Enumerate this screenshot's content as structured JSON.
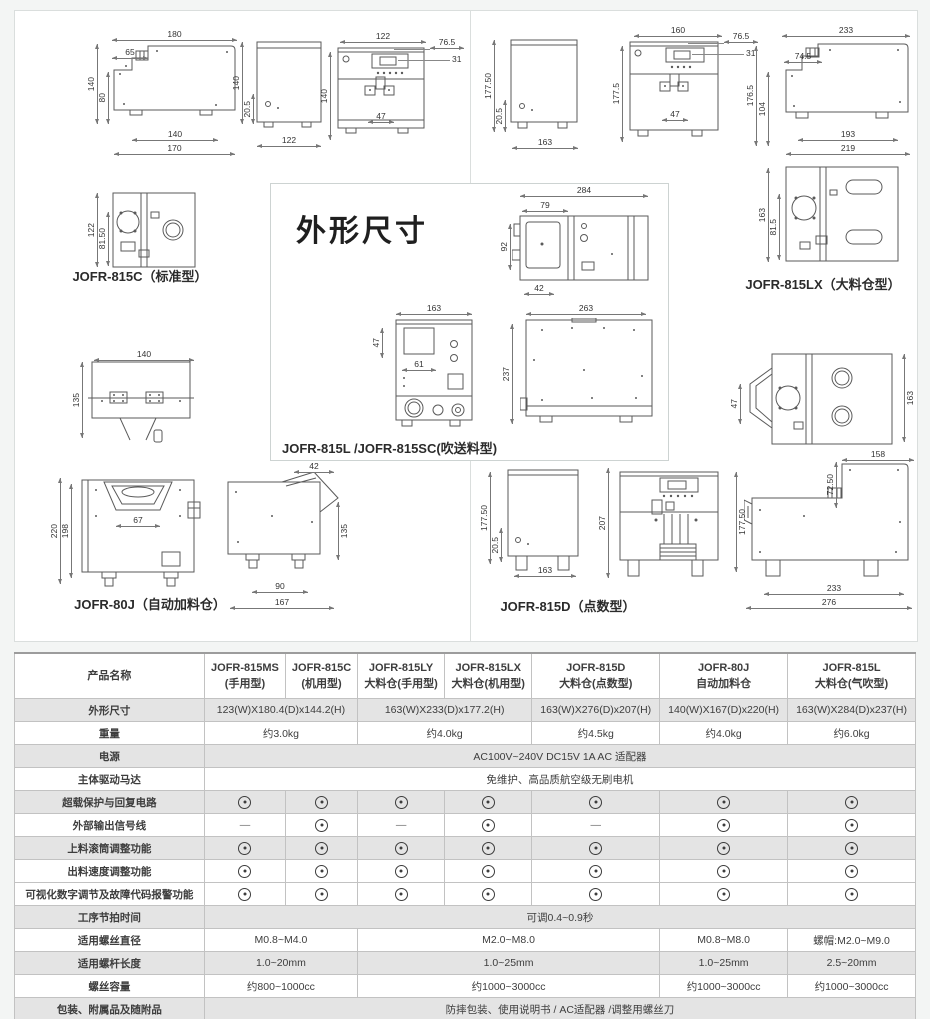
{
  "drawings": {
    "title": "外形尺寸",
    "c": {
      "label": "JOFR-815C（标准型）",
      "side": {
        "top": "180",
        "step": "65",
        "h": "140",
        "h2": "80",
        "bot_in": "140",
        "bot": "170"
      },
      "back": {
        "h": "140",
        "h2": "20.5",
        "w": "122"
      },
      "front": {
        "w": "122",
        "r1": "76.5",
        "r2": "31",
        "h": "140",
        "inner": "47"
      },
      "top": {
        "h": "122",
        "h2": "81.50"
      }
    },
    "hinge": {
      "w": "140",
      "h": "135"
    },
    "j80": {
      "label": "JOFR-80J（自动加料仓）",
      "front": {
        "h": "220",
        "h2": "198",
        "inner": "67"
      },
      "side": {
        "top": "42",
        "r": "135",
        "bot_in": "90",
        "bot": "167"
      }
    },
    "lx": {
      "label": "JOFR-815LX（大料仓型）",
      "back": {
        "h": "177.50",
        "h2": "20.5",
        "w": "163"
      },
      "front": {
        "w": "160",
        "r1": "76.5",
        "r2": "31",
        "h": "177.5",
        "inner": "47"
      },
      "side": {
        "top": "233",
        "step": "74.5",
        "h": "176.5",
        "h2": "104",
        "bot_in": "193",
        "bot": "219"
      },
      "top": {
        "h": "163",
        "h2": "81.5"
      }
    },
    "ltop": {
      "l": "47",
      "r": "163"
    },
    "d": {
      "label": "JOFR-815D（点数型）",
      "back": {
        "h": "177.50",
        "h2": "20.5",
        "w": "163"
      },
      "front": {
        "h": "207",
        "r": "177.50"
      },
      "side": {
        "top": "158",
        "r": "72.50",
        "bot_in": "233",
        "bot": "276"
      }
    },
    "l": {
      "label": "JOFR-815L /JOFR-815SC(吹送料型)",
      "side": {
        "top": "284",
        "in_top": "79",
        "h": "92",
        "in_bot": "42"
      },
      "front": {
        "top": "163",
        "l": "47",
        "inner": "61"
      },
      "side2": {
        "top": "263",
        "h": "237"
      }
    }
  },
  "table": {
    "header": {
      "label": "产品名称",
      "columns": [
        {
          "line1": "JOFR-815MS",
          "line2": "(手用型)"
        },
        {
          "line1": "JOFR-815C",
          "line2": "(机用型)"
        },
        {
          "line1": "JOFR-815LY",
          "line2": "大料仓(手用型)"
        },
        {
          "line1": "JOFR-815LX",
          "line2": "大料仓(机用型)"
        },
        {
          "line1": "JOFR-815D",
          "line2": "大料仓(点数型)"
        },
        {
          "line1": "JOFR-80J",
          "line2": "自动加料仓"
        },
        {
          "line1": "JOFR-815L",
          "line2": "大料仓(气吹型)"
        }
      ]
    },
    "rows": [
      {
        "label": "外形尺寸",
        "shade": true,
        "cells": [
          {
            "span": 2,
            "text": "123(W)X180.4(D)x144.2(H)"
          },
          {
            "span": 2,
            "text": "163(W)X233(D)x177.2(H)"
          },
          {
            "span": 1,
            "text": "163(W)X276(D)x207(H)"
          },
          {
            "span": 1,
            "text": "140(W)X167(D)x220(H)"
          },
          {
            "span": 1,
            "text": "163(W)X284(D)x237(H)"
          }
        ]
      },
      {
        "label": "重量",
        "shade": false,
        "cells": [
          {
            "span": 2,
            "text": "约3.0kg"
          },
          {
            "span": 2,
            "text": "约4.0kg"
          },
          {
            "span": 1,
            "text": "约4.5kg"
          },
          {
            "span": 1,
            "text": "约4.0kg"
          },
          {
            "span": 1,
            "text": "约6.0kg"
          }
        ]
      },
      {
        "label": "电源",
        "shade": true,
        "cells": [
          {
            "span": 7,
            "text": "AC100V~240V DC15V 1A AC 适配器"
          }
        ]
      },
      {
        "label": "主体驱动马达",
        "shade": false,
        "cells": [
          {
            "span": 7,
            "text": "免维护、高品质航空级无刷电机"
          }
        ]
      },
      {
        "label": "超载保护与回复电路",
        "shade": true,
        "cells": [
          {
            "sym": "dot"
          },
          {
            "sym": "dot"
          },
          {
            "sym": "dot"
          },
          {
            "sym": "dot"
          },
          {
            "sym": "dot"
          },
          {
            "sym": "dot"
          },
          {
            "sym": "dot"
          }
        ]
      },
      {
        "label": "外部输出信号线",
        "shade": false,
        "cells": [
          {
            "sym": "dash"
          },
          {
            "sym": "dot"
          },
          {
            "sym": "dash"
          },
          {
            "sym": "dot"
          },
          {
            "sym": "dash"
          },
          {
            "sym": "dot"
          },
          {
            "sym": "dot"
          }
        ]
      },
      {
        "label": "上料滚筒调整功能",
        "shade": true,
        "cells": [
          {
            "sym": "dot"
          },
          {
            "sym": "dot"
          },
          {
            "sym": "dot"
          },
          {
            "sym": "dot"
          },
          {
            "sym": "dot"
          },
          {
            "sym": "dot"
          },
          {
            "sym": "dot"
          }
        ]
      },
      {
        "label": "出料速度调整功能",
        "shade": false,
        "cells": [
          {
            "sym": "dot"
          },
          {
            "sym": "dot"
          },
          {
            "sym": "dot"
          },
          {
            "sym": "dot"
          },
          {
            "sym": "dot"
          },
          {
            "sym": "dot"
          },
          {
            "sym": "dot"
          }
        ]
      },
      {
        "label": "可视化数字调节及故障代码报警功能",
        "shade": false,
        "cells": [
          {
            "sym": "dot"
          },
          {
            "sym": "dot"
          },
          {
            "sym": "dot"
          },
          {
            "sym": "dot"
          },
          {
            "sym": "dot"
          },
          {
            "sym": "dot"
          },
          {
            "sym": "dot"
          }
        ]
      },
      {
        "label": "工序节拍时间",
        "shade": true,
        "cells": [
          {
            "span": 7,
            "text": "可调0.4~0.9秒"
          }
        ]
      },
      {
        "label": "适用螺丝直径",
        "shade": false,
        "cells": [
          {
            "span": 2,
            "text": "M0.8~M4.0"
          },
          {
            "span": 3,
            "text": "M2.0~M8.0"
          },
          {
            "span": 1,
            "text": "M0.8~M8.0"
          },
          {
            "span": 1,
            "text": "螺帽:M2.0~M9.0"
          }
        ]
      },
      {
        "label": "适用螺杆长度",
        "shade": true,
        "cells": [
          {
            "span": 2,
            "text": "1.0~20mm"
          },
          {
            "span": 3,
            "text": "1.0~25mm"
          },
          {
            "span": 1,
            "text": "1.0~25mm"
          },
          {
            "span": 1,
            "text": "2.5~20mm"
          }
        ]
      },
      {
        "label": "螺丝容量",
        "shade": false,
        "cells": [
          {
            "span": 2,
            "text": "约800~1000cc"
          },
          {
            "span": 3,
            "text": "约1000~3000cc"
          },
          {
            "span": 1,
            "text": "约1000~3000cc"
          },
          {
            "span": 1,
            "text": "约1000~3000cc"
          }
        ]
      },
      {
        "label": "包装、附属品及随附品",
        "shade": true,
        "cells": [
          {
            "span": 7,
            "text": "防摔包装、使用说明书 / AC适配器 /调整用螺丝刀"
          }
        ]
      }
    ]
  }
}
